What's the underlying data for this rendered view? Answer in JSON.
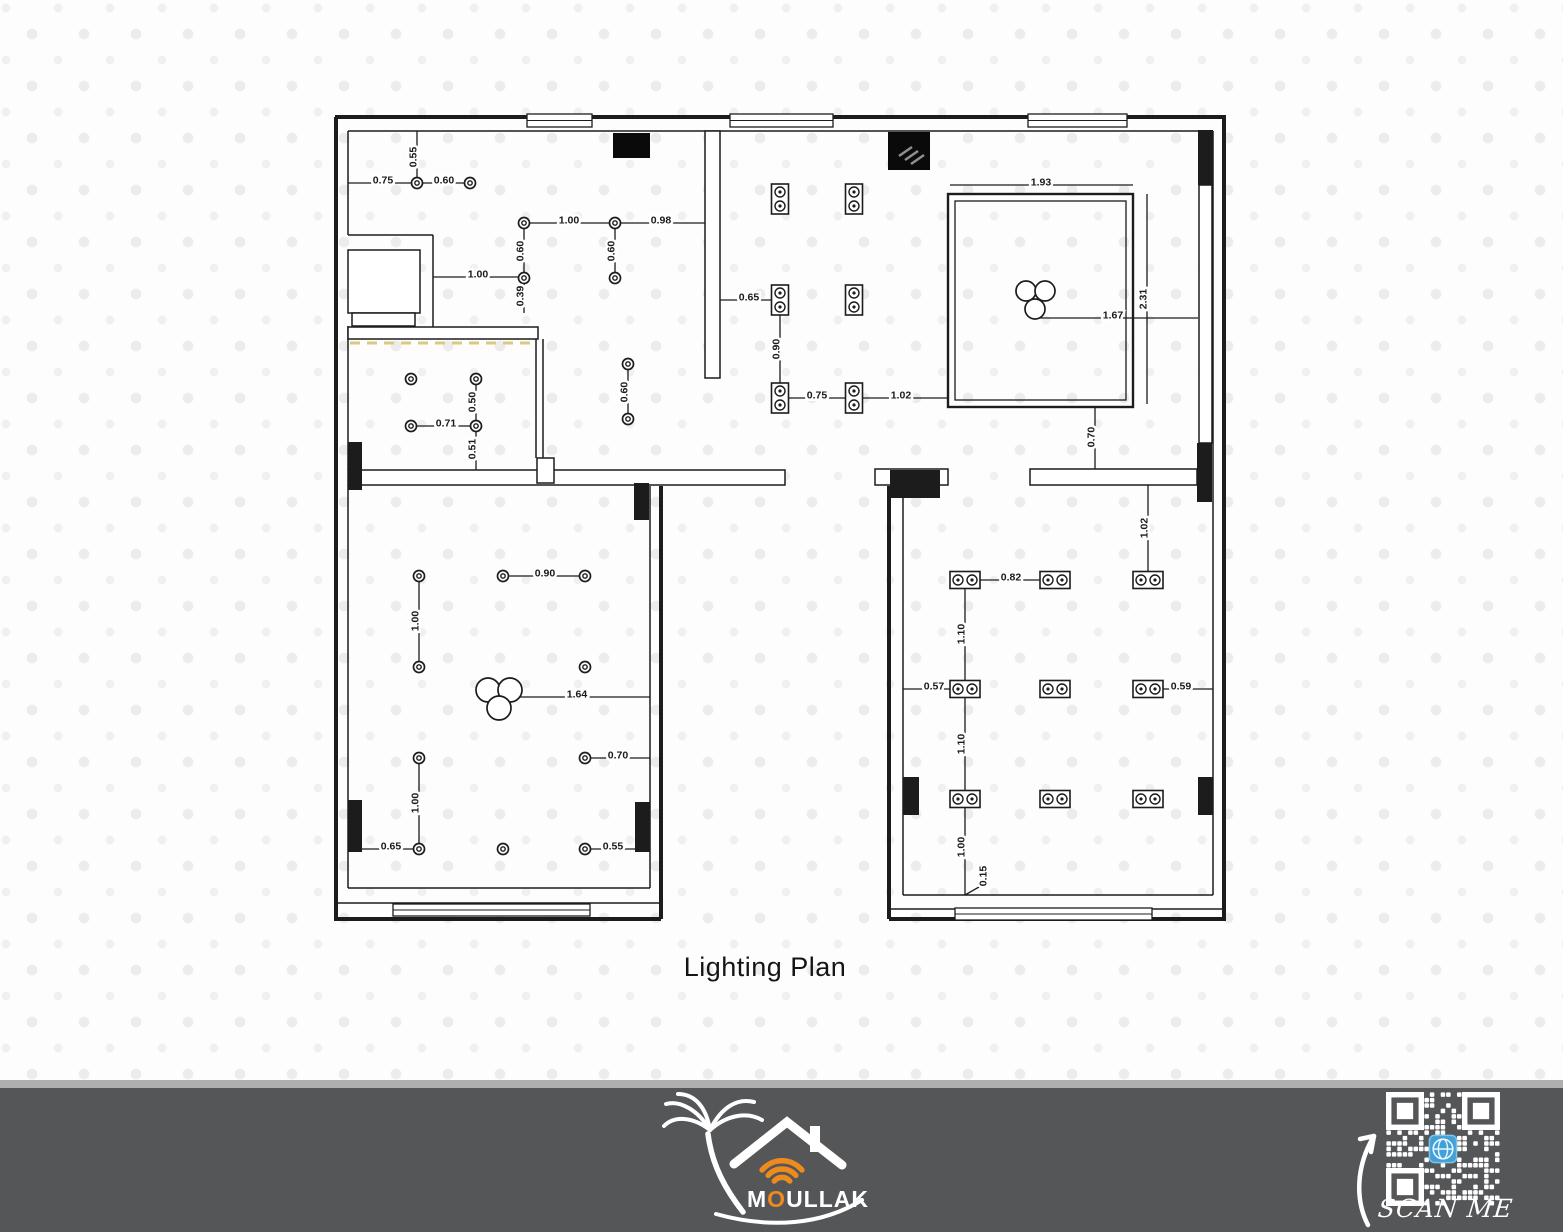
{
  "title": "Lighting Plan",
  "footer": {
    "brand_m": "M",
    "brand_o": "O",
    "brand_rest": "ULLAK",
    "scan_me": "SCAN ME"
  },
  "colors": {
    "ink": "#1c1c1c",
    "led": "#ddc97e",
    "footer_bg": "#555658",
    "footer_strip": "#aeafb1",
    "orange": "#ee8b1e",
    "qr_blue": "#42a0d8",
    "dot": "#ececec",
    "white": "#ffffff",
    "hatch": "#8f8f8f"
  },
  "plan": {
    "outer_walls": [
      [
        335,
        117,
        1226,
        117
      ],
      [
        1224,
        117,
        1224,
        921
      ],
      [
        889,
        919,
        1226,
        919
      ],
      [
        889,
        486,
        889,
        919
      ],
      [
        661,
        486,
        661,
        919
      ],
      [
        335,
        919,
        661,
        919
      ],
      [
        336,
        117,
        336,
        921
      ]
    ],
    "inner_lines": [
      [
        348,
        131,
        1213,
        131
      ],
      [
        348,
        131,
        348,
        235
      ],
      [
        348,
        235,
        433,
        235
      ],
      [
        433,
        235,
        433,
        327
      ],
      [
        348,
        326,
        348,
        470
      ],
      [
        536,
        339,
        536,
        458
      ],
      [
        543,
        339,
        543,
        458
      ],
      [
        348,
        485,
        348,
        888
      ],
      [
        650,
        486,
        650,
        888
      ],
      [
        903,
        498,
        903,
        895
      ],
      [
        1213,
        131,
        1213,
        895
      ],
      [
        348,
        888,
        650,
        888
      ],
      [
        335,
        903,
        661,
        903
      ],
      [
        903,
        895,
        1213,
        895
      ],
      [
        889,
        909,
        1226,
        909
      ]
    ],
    "slabs": [
      [
        348,
        470,
        437,
        15
      ],
      [
        875,
        469,
        73,
        16
      ],
      [
        1030,
        469,
        167,
        16
      ]
    ],
    "boxes": [
      [
        348,
        250,
        72,
        63
      ],
      [
        352,
        313,
        63,
        13
      ],
      [
        348,
        327,
        190,
        12
      ],
      [
        537,
        458,
        17,
        25
      ],
      [
        705,
        131,
        15,
        247
      ],
      [
        1199,
        185,
        13,
        258
      ]
    ],
    "windows": [
      [
        527,
        114,
        65,
        13
      ],
      [
        730,
        114,
        103,
        13
      ],
      [
        1028,
        114,
        99,
        13
      ],
      [
        393,
        904,
        197,
        12
      ],
      [
        955,
        908,
        197,
        12
      ]
    ],
    "columns": [
      [
        348,
        442,
        14,
        48
      ],
      [
        634,
        483,
        15,
        37
      ],
      [
        890,
        470,
        50,
        28
      ],
      [
        1197,
        443,
        15,
        59
      ],
      [
        348,
        800,
        14,
        52
      ],
      [
        635,
        802,
        15,
        50
      ],
      [
        903,
        777,
        16,
        38
      ],
      [
        1198,
        777,
        15,
        38
      ],
      [
        1198,
        130,
        15,
        55
      ]
    ],
    "ac_units": [
      [
        613,
        133,
        37,
        25
      ],
      [
        888,
        132,
        42,
        38
      ]
    ],
    "ac_hatch": [
      [
        899,
        156,
        912,
        147
      ],
      [
        905,
        160,
        918,
        151
      ],
      [
        911,
        164,
        924,
        155
      ]
    ],
    "led_strip": [
      350,
      343,
      537,
      343
    ],
    "tray": {
      "outer": [
        948,
        194,
        185,
        213
      ],
      "inner": [
        955,
        201,
        171,
        199
      ]
    },
    "downlights": [
      [
        417,
        183
      ],
      [
        470,
        183
      ],
      [
        524,
        223
      ],
      [
        615,
        223
      ],
      [
        524,
        278
      ],
      [
        615,
        278
      ],
      [
        628,
        364
      ],
      [
        628,
        419
      ],
      [
        411,
        379
      ],
      [
        476,
        379
      ],
      [
        411,
        426
      ],
      [
        476,
        426
      ],
      [
        419,
        576
      ],
      [
        503,
        576
      ],
      [
        585,
        576
      ],
      [
        419,
        667
      ],
      [
        585,
        667
      ],
      [
        419,
        758
      ],
      [
        585,
        758
      ],
      [
        419,
        849
      ],
      [
        503,
        849
      ],
      [
        585,
        849
      ]
    ],
    "spots_v": [
      [
        780,
        199
      ],
      [
        854,
        199
      ],
      [
        780,
        300
      ],
      [
        854,
        300
      ],
      [
        780,
        398
      ],
      [
        854,
        398
      ]
    ],
    "spots_h": [
      [
        965,
        580
      ],
      [
        1055,
        580
      ],
      [
        1148,
        580
      ],
      [
        965,
        689
      ],
      [
        1055,
        689
      ],
      [
        1148,
        689
      ],
      [
        965,
        799
      ],
      [
        1055,
        799
      ],
      [
        1148,
        799
      ]
    ],
    "chandeliers": [
      {
        "circles": [
          [
            1026,
            291,
            10
          ],
          [
            1045,
            291,
            10
          ],
          [
            1035,
            309,
            10
          ]
        ]
      },
      {
        "circles": [
          [
            488,
            690,
            12
          ],
          [
            510,
            690,
            12
          ],
          [
            499,
            708,
            12
          ]
        ]
      }
    ],
    "dimensions": [
      {
        "t": "0.55",
        "l": [
          417,
          131,
          417,
          183
        ],
        "p": [
          413,
          157
        ],
        "v": 1
      },
      {
        "t": "0.75",
        "l": [
          348,
          183,
          417,
          183
        ],
        "p": [
          383,
          180
        ]
      },
      {
        "t": "0.60",
        "l": [
          417,
          183,
          470,
          183
        ],
        "p": [
          444,
          180
        ]
      },
      {
        "t": "1.00",
        "l": [
          524,
          223,
          615,
          223
        ],
        "p": [
          569,
          220
        ]
      },
      {
        "t": "0.98",
        "l": [
          615,
          223,
          705,
          223
        ],
        "p": [
          661,
          220
        ]
      },
      {
        "t": "0.60",
        "l": [
          524,
          223,
          524,
          278
        ],
        "p": [
          520,
          251
        ],
        "v": 1
      },
      {
        "t": "0.60",
        "l": [
          615,
          223,
          615,
          278
        ],
        "p": [
          611,
          251
        ],
        "v": 1
      },
      {
        "t": "1.00",
        "l": [
          433,
          277,
          524,
          277
        ],
        "p": [
          478,
          274
        ]
      },
      {
        "t": "0.39",
        "l": [
          524,
          277,
          524,
          313
        ],
        "p": [
          520,
          296
        ],
        "v": 1
      },
      {
        "t": "0.60",
        "l": [
          628,
          364,
          628,
          419
        ],
        "p": [
          624,
          392
        ],
        "v": 1
      },
      {
        "t": "0.50",
        "l": [
          476,
          379,
          476,
          426
        ],
        "p": [
          472,
          402
        ],
        "v": 1
      },
      {
        "t": "0.71",
        "l": [
          411,
          426,
          476,
          426
        ],
        "p": [
          446,
          423
        ]
      },
      {
        "t": "0.51",
        "l": [
          476,
          426,
          476,
          470
        ],
        "p": [
          472,
          449
        ],
        "v": 1
      },
      {
        "t": "0.65",
        "l": [
          720,
          300,
          780,
          300
        ],
        "p": [
          749,
          297
        ]
      },
      {
        "t": "0.90",
        "l": [
          780,
          300,
          780,
          398
        ],
        "p": [
          776,
          349
        ],
        "v": 1
      },
      {
        "t": "0.75",
        "l": [
          780,
          398,
          854,
          398
        ],
        "p": [
          817,
          395
        ]
      },
      {
        "t": "1.02",
        "l": [
          854,
          398,
          948,
          398
        ],
        "p": [
          901,
          395
        ]
      },
      {
        "t": "1.93",
        "l": [
          950,
          185,
          1133,
          185
        ],
        "p": [
          1041,
          182
        ]
      },
      {
        "t": "2.31",
        "l": [
          1147,
          194,
          1147,
          404
        ],
        "p": [
          1143,
          299
        ],
        "v": 1
      },
      {
        "t": "1.67",
        "l": [
          1035,
          318,
          1198,
          318
        ],
        "p": [
          1113,
          315
        ]
      },
      {
        "t": "0.70",
        "l": [
          1095,
          407,
          1095,
          469
        ],
        "p": [
          1091,
          437
        ],
        "v": 1
      },
      {
        "t": "0.90",
        "l": [
          503,
          576,
          585,
          576
        ],
        "p": [
          545,
          573
        ]
      },
      {
        "t": "1.00",
        "l": [
          419,
          576,
          419,
          667
        ],
        "p": [
          415,
          621
        ],
        "v": 1
      },
      {
        "t": "1.64",
        "l": [
          505,
          697,
          650,
          697
        ],
        "p": [
          577,
          694
        ]
      },
      {
        "t": "0.70",
        "l": [
          585,
          758,
          650,
          758
        ],
        "p": [
          618,
          755
        ]
      },
      {
        "t": "1.00",
        "l": [
          419,
          758,
          419,
          849
        ],
        "p": [
          415,
          803
        ],
        "v": 1
      },
      {
        "t": "0.65",
        "l": [
          362,
          849,
          419,
          849
        ],
        "p": [
          391,
          846
        ]
      },
      {
        "t": "0.55",
        "l": [
          585,
          849,
          650,
          849
        ],
        "p": [
          613,
          846
        ]
      },
      {
        "t": "1.02",
        "l": [
          1148,
          485,
          1148,
          580
        ],
        "p": [
          1144,
          528
        ],
        "v": 1
      },
      {
        "t": "0.82",
        "l": [
          965,
          580,
          1055,
          580
        ],
        "p": [
          1011,
          577
        ]
      },
      {
        "t": "1.10",
        "l": [
          965,
          580,
          965,
          689
        ],
        "p": [
          961,
          634
        ],
        "v": 1
      },
      {
        "t": "0.57",
        "l": [
          903,
          689,
          965,
          689
        ],
        "p": [
          934,
          686
        ]
      },
      {
        "t": "0.59",
        "l": [
          1148,
          689,
          1213,
          689
        ],
        "p": [
          1181,
          686
        ]
      },
      {
        "t": "1.10",
        "l": [
          965,
          689,
          965,
          799
        ],
        "p": [
          961,
          744
        ],
        "v": 1
      },
      {
        "t": "1.00",
        "l": [
          965,
          799,
          965,
          895
        ],
        "p": [
          961,
          847
        ],
        "v": 1
      },
      {
        "t": "0.15",
        "l": [
          965,
          895,
          979,
          887
        ],
        "p": [
          983,
          876
        ],
        "v": 1
      }
    ]
  }
}
